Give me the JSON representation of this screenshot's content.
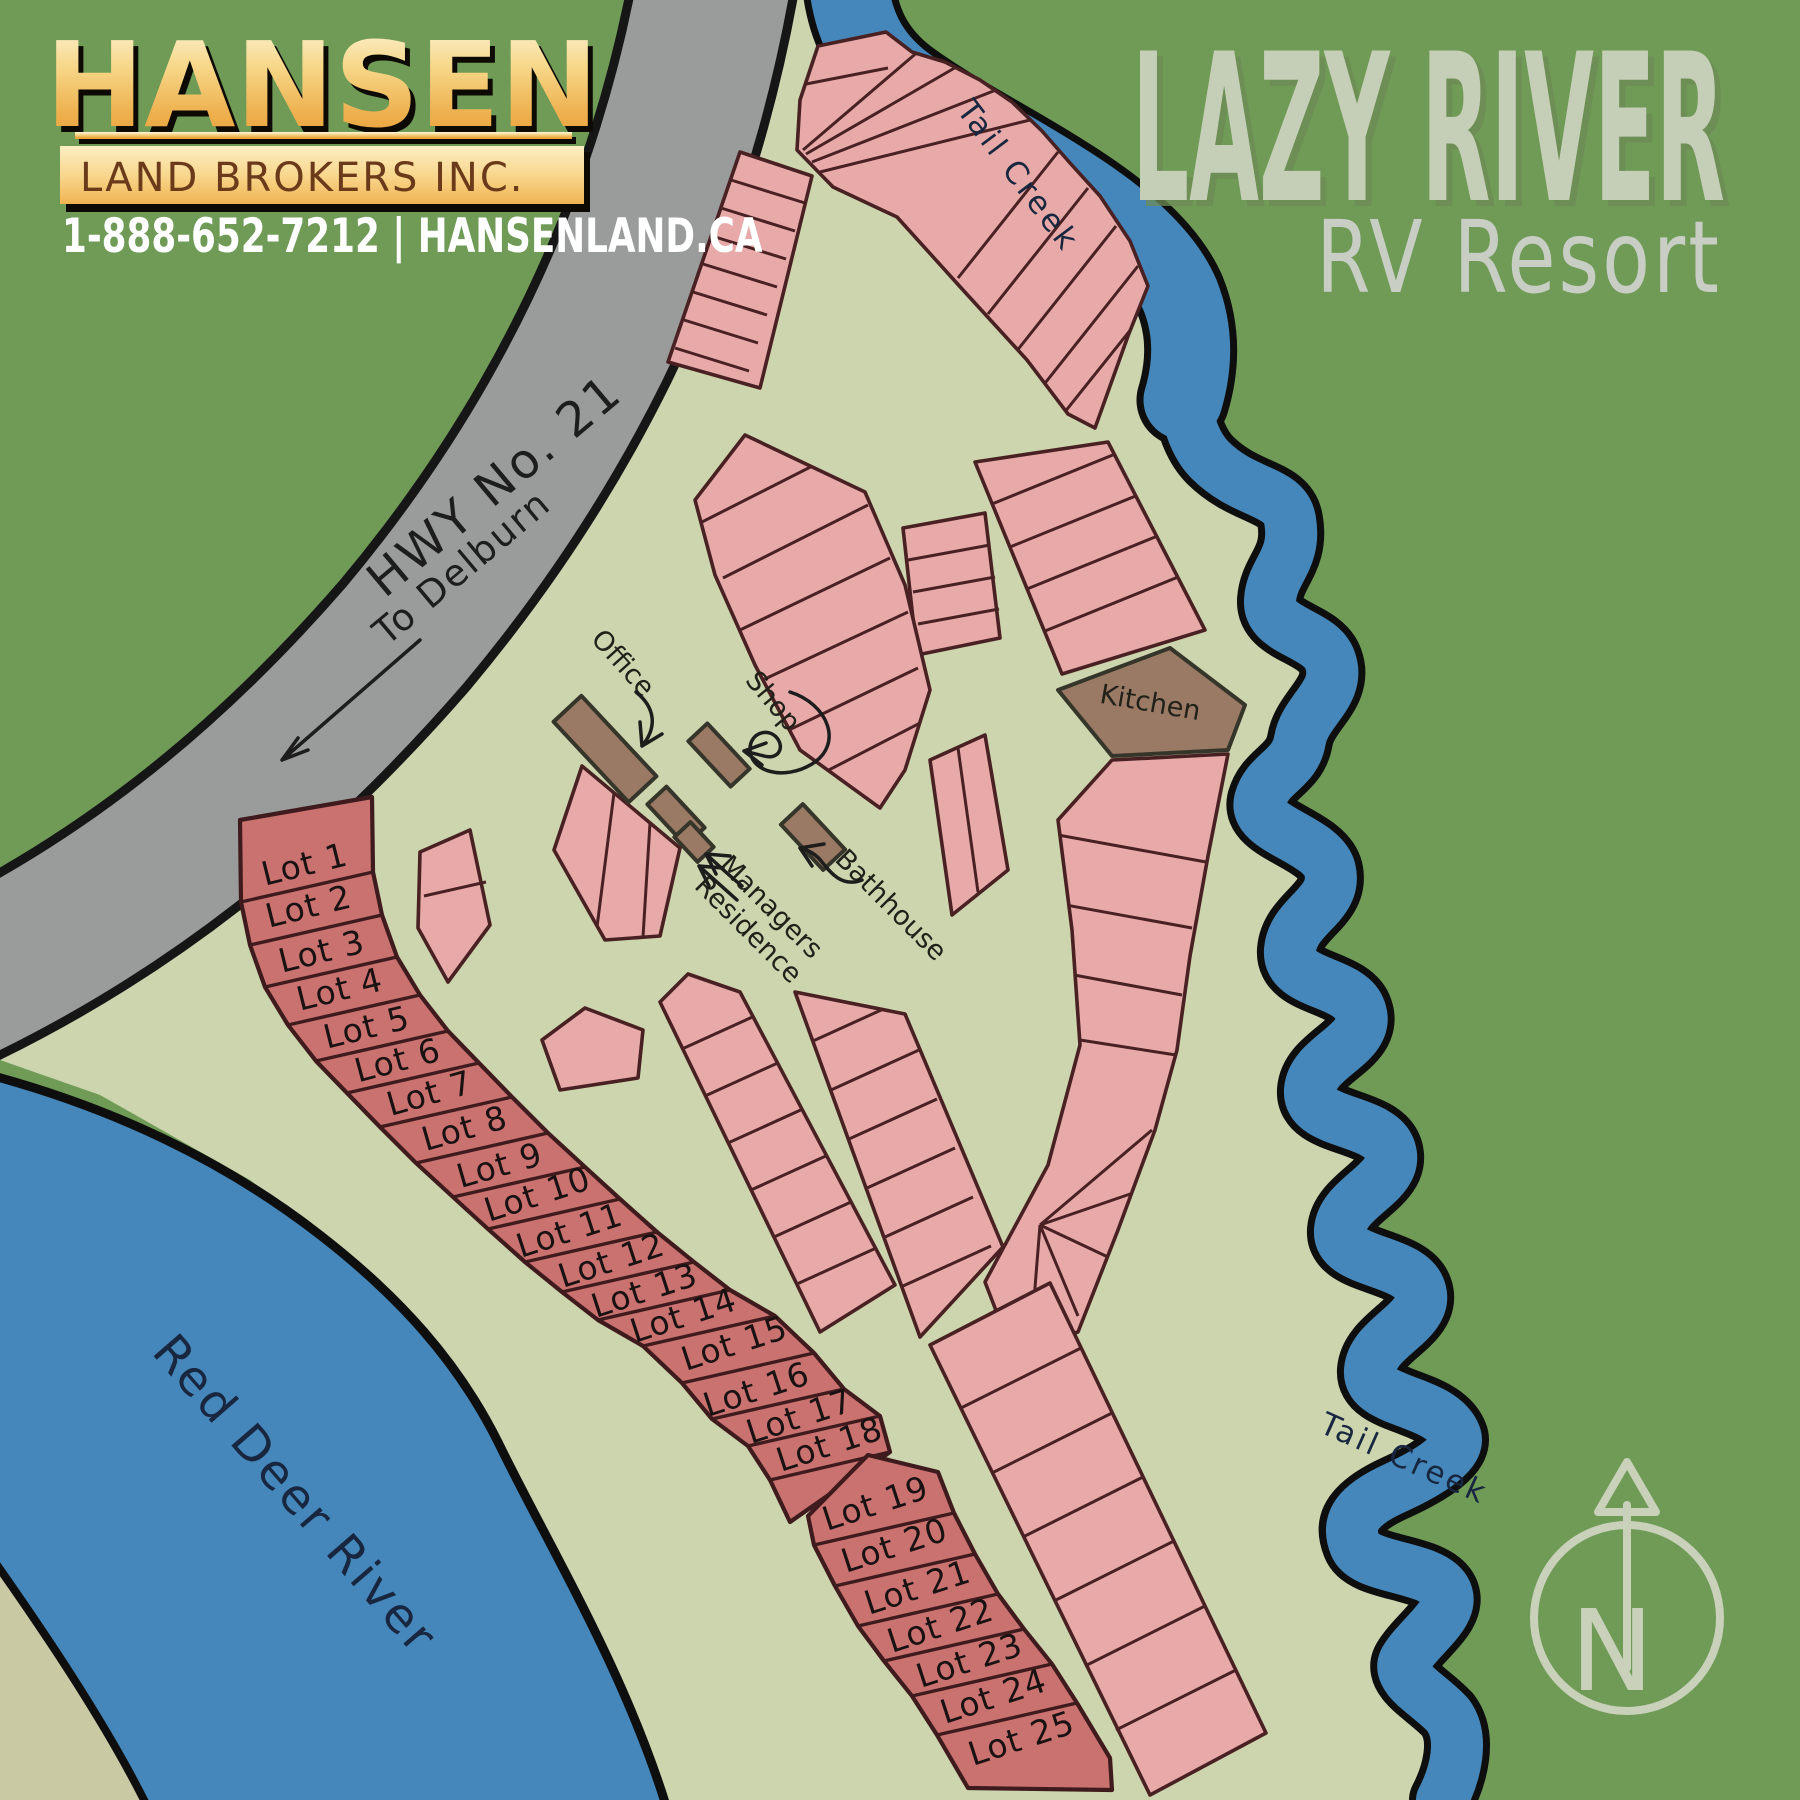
{
  "branding": {
    "name": "HANSEN",
    "subtitle": "LAND BROKERS INC.",
    "contact": "1-888-652-7212 | HANSENLAND.CA"
  },
  "title": {
    "main": "LAZY RIVER",
    "sub": "RV Resort"
  },
  "labels": {
    "highway": "HWY No. 21",
    "highway_direction": "To Delburn",
    "river": "Red Deer River",
    "creek_upper": "Tail Creek",
    "creek_lower": "Tail Creek",
    "office": "Office",
    "shop": "Shop",
    "managers_residence_line1": "Managers",
    "managers_residence_line2": "Residence",
    "bathhouse": "Bathhouse",
    "kitchen": "Kitchen",
    "compass_north": "N"
  },
  "lots": [
    {
      "label": "Lot 1"
    },
    {
      "label": "Lot 2"
    },
    {
      "label": "Lot 3"
    },
    {
      "label": "Lot 4"
    },
    {
      "label": "Lot 5"
    },
    {
      "label": "Lot 6"
    },
    {
      "label": "Lot 7"
    },
    {
      "label": "Lot 8"
    },
    {
      "label": "Lot 9"
    },
    {
      "label": "Lot 10"
    },
    {
      "label": "Lot 11"
    },
    {
      "label": "Lot 12"
    },
    {
      "label": "Lot 13"
    },
    {
      "label": "Lot 14"
    },
    {
      "label": "Lot 15"
    },
    {
      "label": "Lot 16"
    },
    {
      "label": "Lot 17"
    },
    {
      "label": "Lot 18"
    },
    {
      "label": "Lot 19"
    },
    {
      "label": "Lot 20"
    },
    {
      "label": "Lot 21"
    },
    {
      "label": "Lot 22"
    },
    {
      "label": "Lot 23"
    },
    {
      "label": "Lot 24"
    },
    {
      "label": "Lot 25"
    }
  ],
  "colors": {
    "field_green": "#6f9b57",
    "resort_green": "#ccd5ae",
    "water_blue": "#4587ba",
    "highway_gray": "#9a9c9b",
    "site_pink": "#e7aaa9",
    "numbered_lot_red": "#ca7270",
    "building_brown": "#9a7a64",
    "logo_gold": "#eeb14f",
    "title_sage": "#c5ceb6"
  }
}
